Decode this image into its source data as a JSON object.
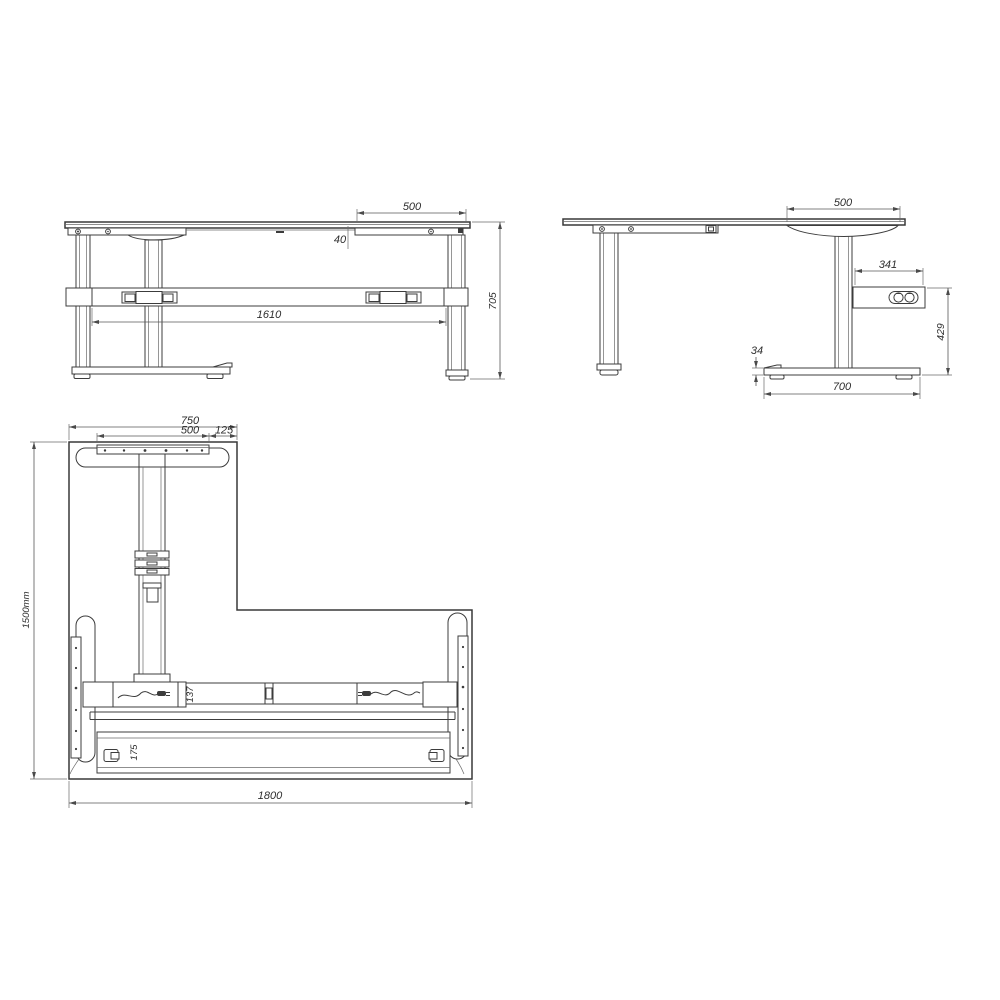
{
  "page": {
    "background": "#ffffff",
    "line_color": "#3c3c3c",
    "dim_color": "#585858"
  },
  "views": {
    "front": {
      "label": "front-elevation",
      "dims": {
        "bracket_width": "500",
        "bracket_drop": "40",
        "leg_spacing": "1610",
        "overall_height": "705"
      }
    },
    "side": {
      "label": "side-elevation",
      "dims": {
        "bracket_width": "500",
        "control_box_width": "341",
        "control_box_floor_height": "429",
        "foot_height": "34",
        "foot_length": "700"
      }
    },
    "plan": {
      "label": "plan-view",
      "dims": {
        "return_width": "750",
        "bracket_width": "500",
        "edge_offset": "125",
        "overall_depth": "1500mm",
        "beam_width": "137",
        "rail_width": "175",
        "overall_width": "1800"
      }
    }
  }
}
